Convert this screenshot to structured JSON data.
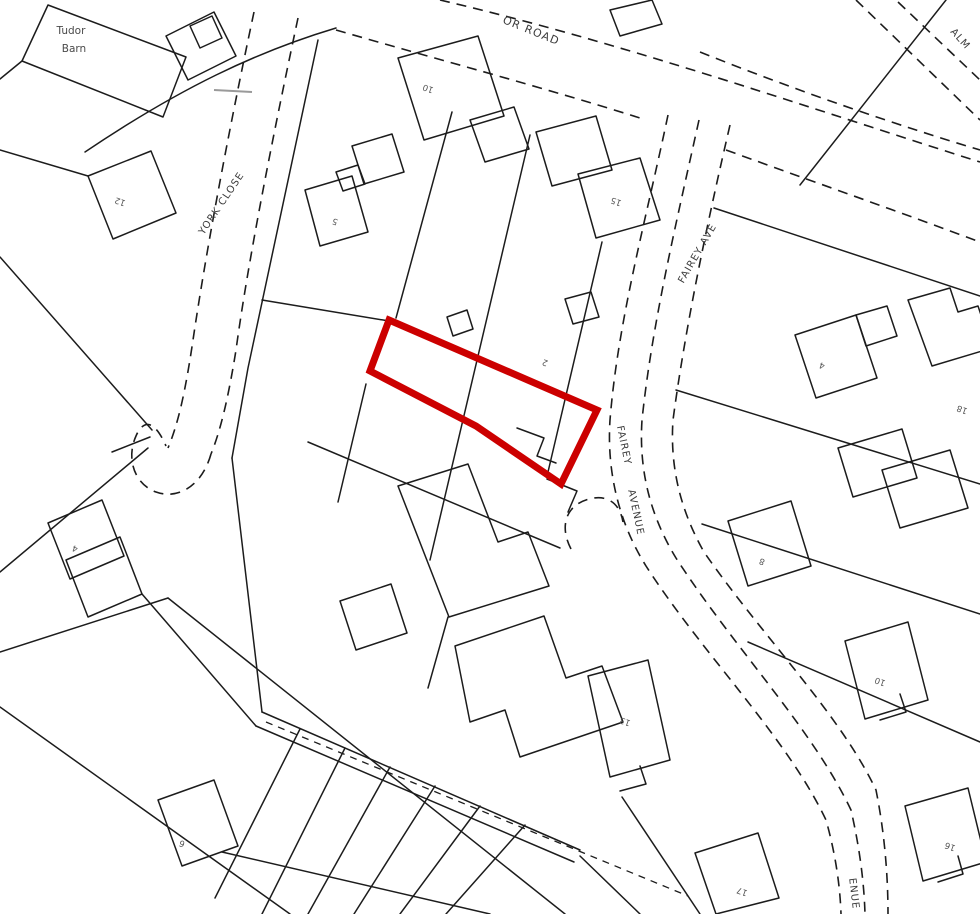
{
  "map": {
    "colors": {
      "background": "#ffffff",
      "linework": "#1c1c1c",
      "highlight_outline": "#cc0000",
      "road_label": "#3c3c3c",
      "plot_number": "#555555"
    },
    "road_labels": [
      {
        "id": "tudor-road-fragment",
        "text": "OR ROAD"
      },
      {
        "id": "york-close",
        "text": "YORK CLOSE"
      },
      {
        "id": "fairey-ave",
        "text": "FAIREY AVE"
      },
      {
        "id": "fairey",
        "text": "FAIREY"
      },
      {
        "id": "avenue",
        "text": "AVENUE"
      },
      {
        "id": "avenue-fragment",
        "text": "ENUE"
      },
      {
        "id": "alm-fragment",
        "text": "ALM"
      }
    ],
    "place_labels": [
      {
        "text": "Tudor"
      },
      {
        "text": "Barn"
      }
    ],
    "plot_numbers": [
      {
        "text": "12"
      },
      {
        "text": "10"
      },
      {
        "text": "5"
      },
      {
        "text": "15"
      },
      {
        "text": "2"
      },
      {
        "text": "4"
      },
      {
        "text": "18"
      },
      {
        "text": "8"
      },
      {
        "text": "10"
      },
      {
        "text": "4"
      },
      {
        "text": "6"
      },
      {
        "text": "13"
      },
      {
        "text": "17"
      },
      {
        "text": "16"
      }
    ]
  }
}
